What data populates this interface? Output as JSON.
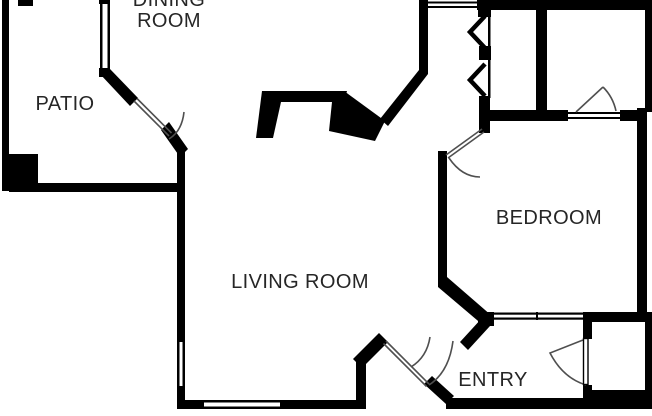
{
  "title": "Apartment floor plan",
  "floorplan": {
    "rooms": {
      "dining": {
        "label": "DINING ROOM"
      },
      "patio": {
        "label": "PATIO"
      },
      "living": {
        "label": "LIVING ROOM"
      },
      "bedroom": {
        "label": "BEDROOM"
      },
      "entry": {
        "label": "ENTRY"
      }
    },
    "symbols": [
      "door-swing-arc",
      "window",
      "bifold-closet-door",
      "fireplace",
      "closet"
    ],
    "colors": {
      "wall": "#000000",
      "door_arc": "#4f4f4f",
      "label": "#262626",
      "bg": "#ffffff"
    }
  }
}
